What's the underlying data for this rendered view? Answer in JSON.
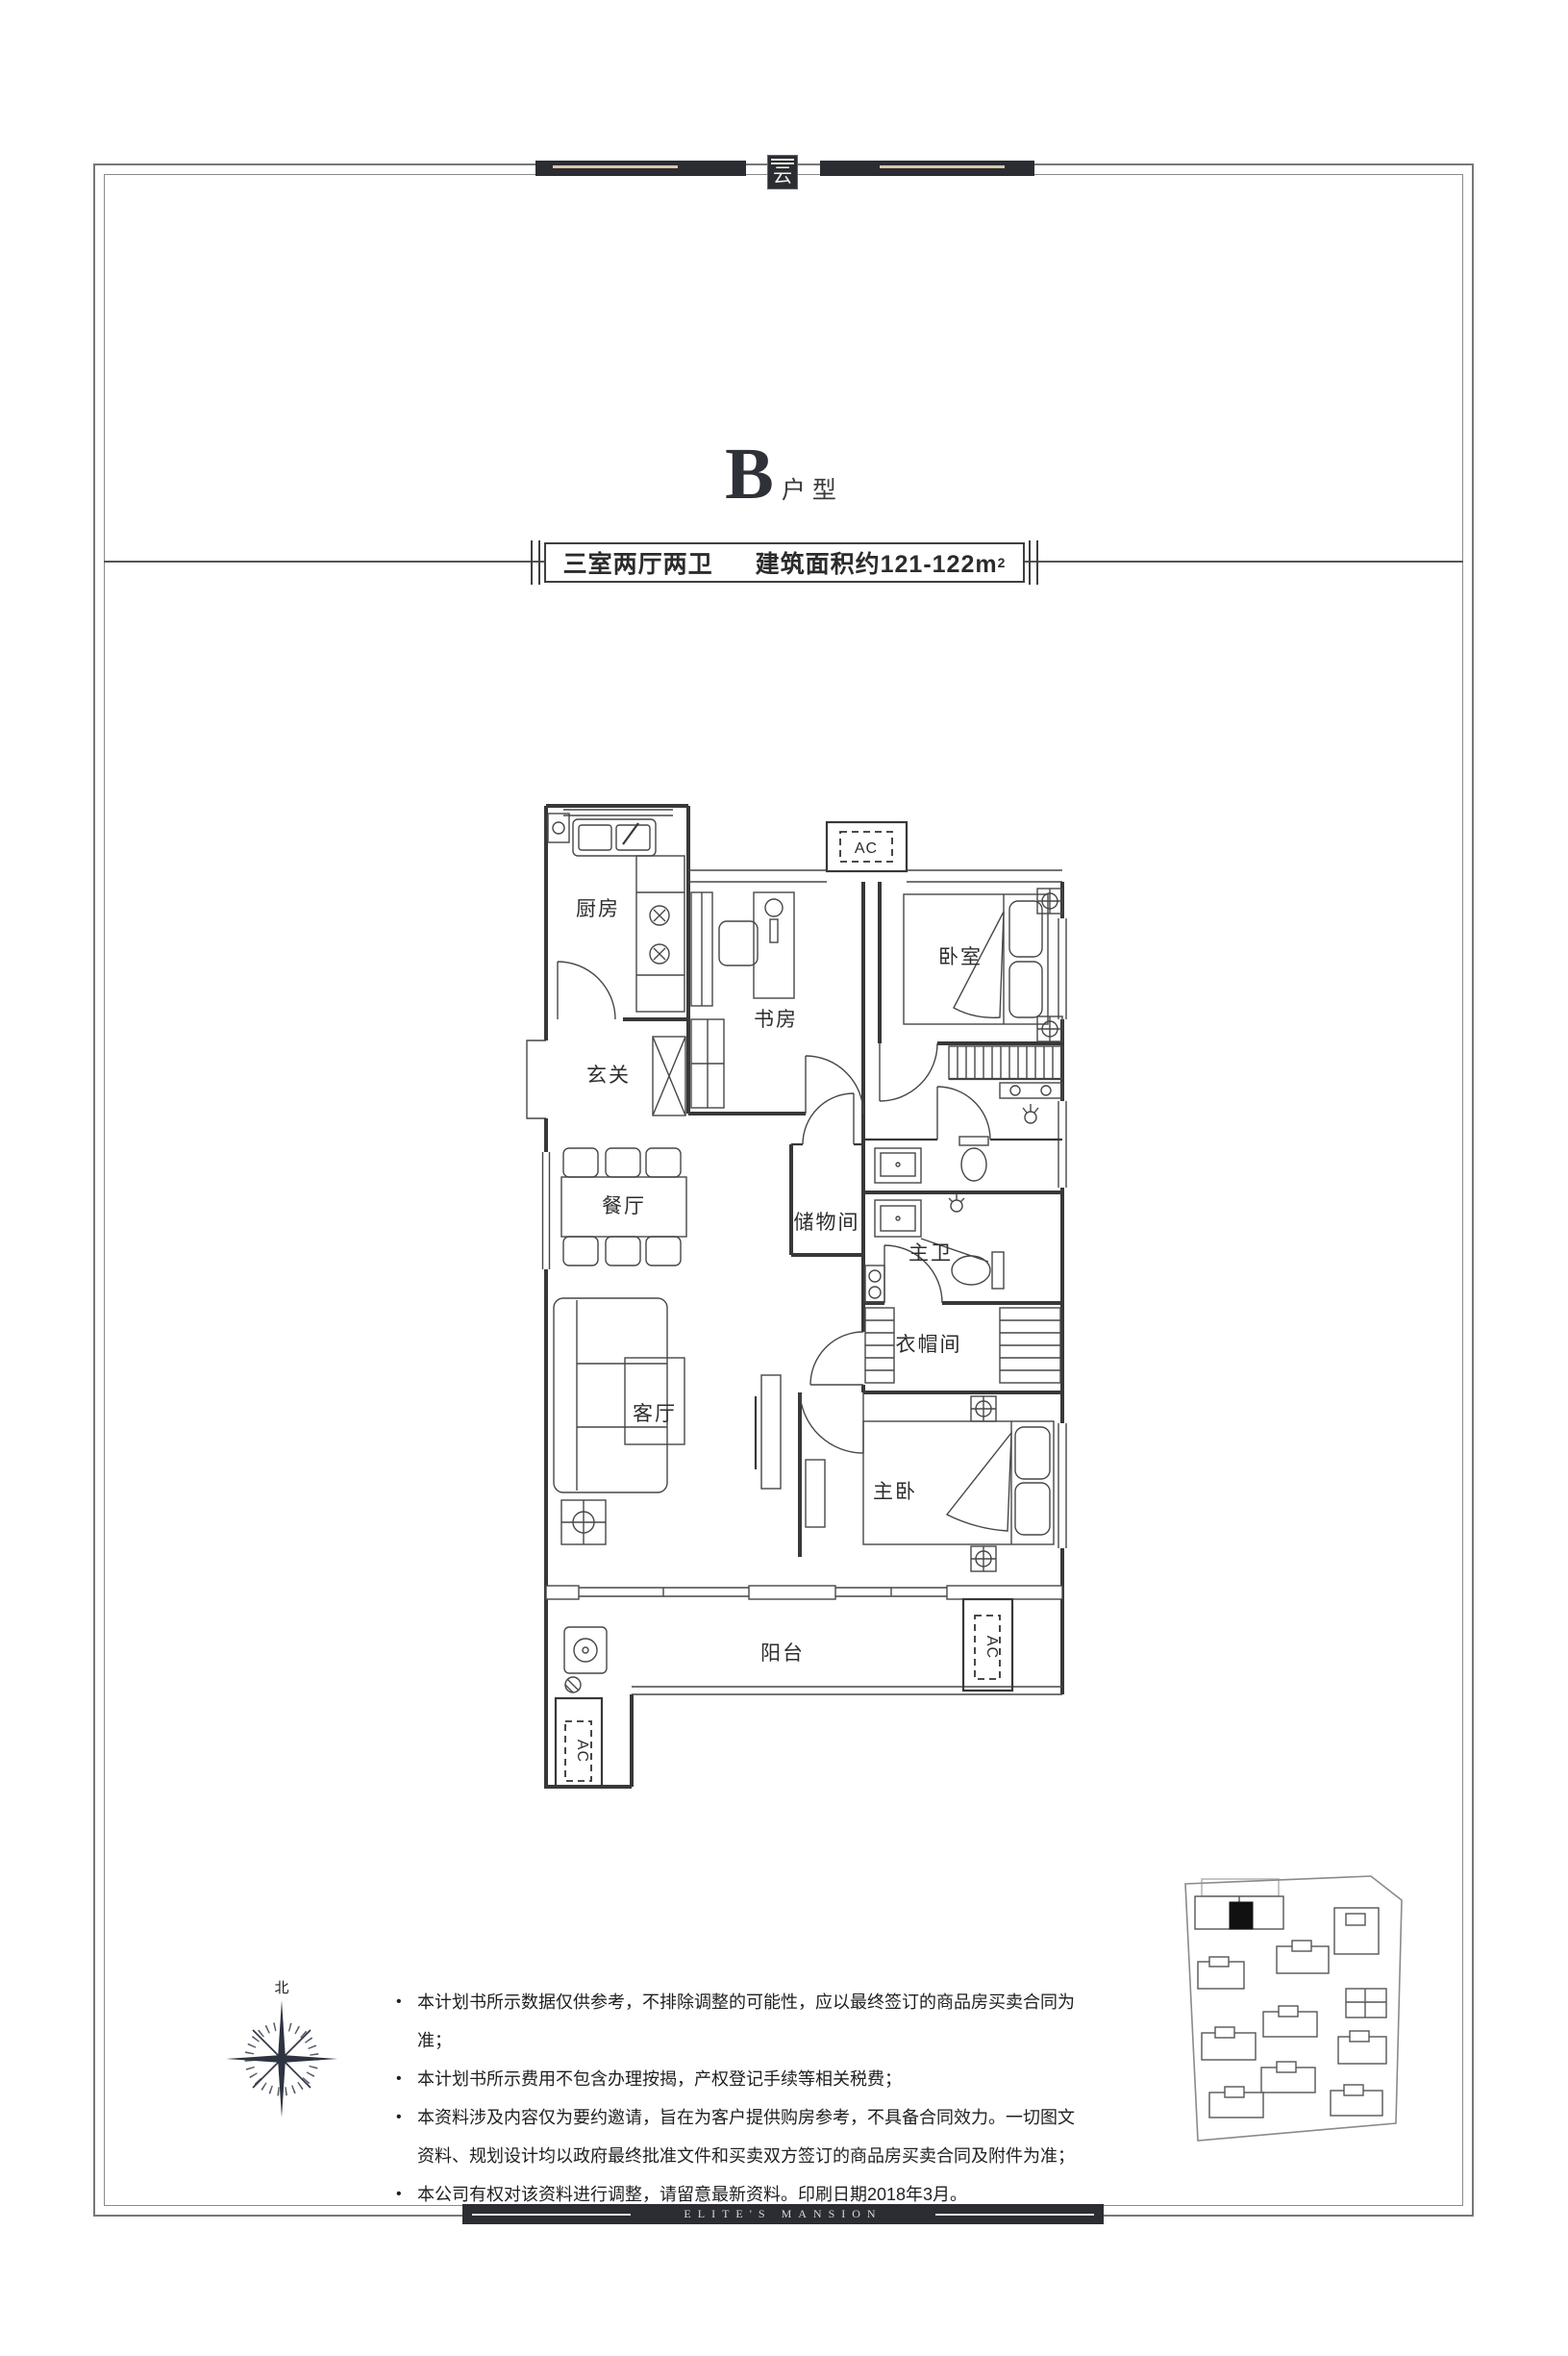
{
  "brand": {
    "badge_glyph": "云",
    "banner_text": "ELITE'S MANSION"
  },
  "header": {
    "title_letter": "B",
    "title_suffix": "户型",
    "spec_left": "三室两厅两卫",
    "spec_right": "建筑面积约121-122m",
    "spec_sup": "2"
  },
  "floorplan": {
    "ac_label": "AC",
    "rooms": {
      "kitchen": "厨房",
      "foyer": "玄关",
      "study": "书房",
      "bedroom": "卧室",
      "dining": "餐厅",
      "storage": "储物间",
      "master_bath": "主卫",
      "closet": "衣帽间",
      "living": "客厅",
      "master_bedroom": "主卧",
      "balcony": "阳台"
    }
  },
  "compass": {
    "north": "北"
  },
  "disclaimer": {
    "bullet_glyph": "•",
    "bullets": [
      "本计划书所示数据仅供参考，不排除调整的可能性，应以最终签订的商品房买卖合同为准；",
      "本计划书所示费用不包含办理按揭，产权登记手续等相关税费；",
      "本资料涉及内容仅为要约邀请，旨在为客户提供购房参考，不具备合同效力。一切图文资料、规划设计均以政府最终批准文件和买卖双方签订的商品房买卖合同及附件为准；",
      "本公司有权对该资料进行调整，请留意最新资料。印刷日期2018年3月。"
    ]
  }
}
